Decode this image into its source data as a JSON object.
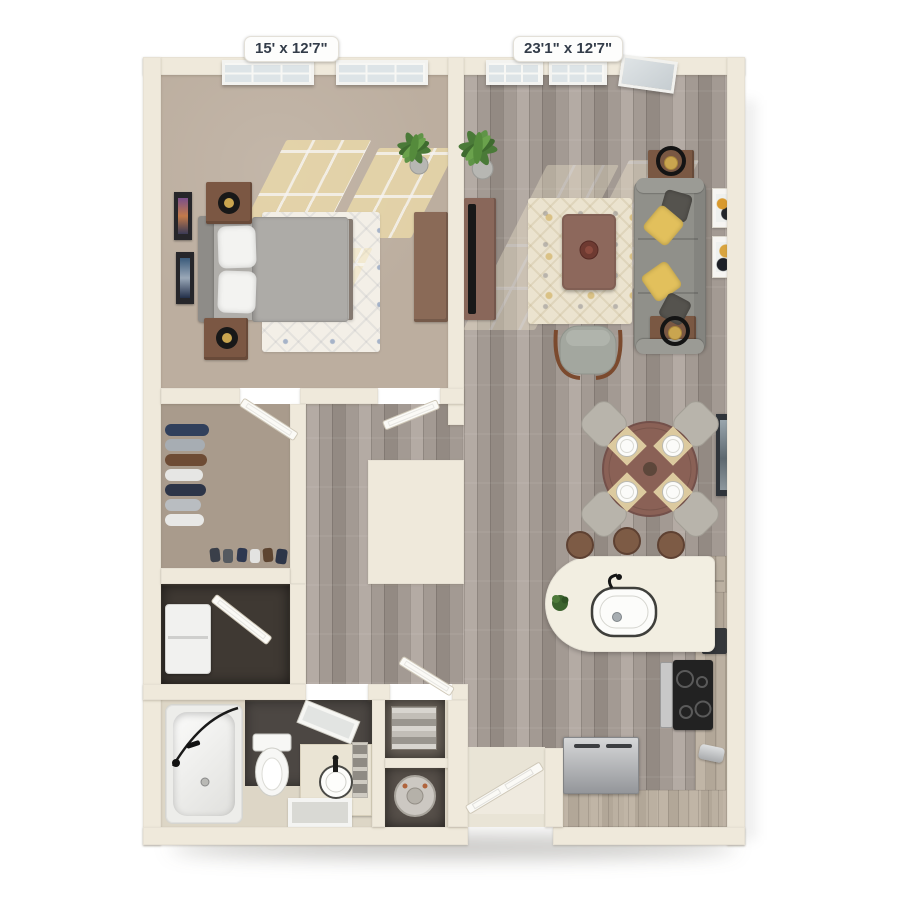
{
  "labels": {
    "bedroom_dimensions": "15' x 12'7\"",
    "living_dimensions": "23'1\" x 12'7\""
  },
  "palette": {
    "bg": "#ffffff",
    "wall": "#efe9db",
    "carpet": "#bcae9f",
    "carpet_closet": "#a99b8c",
    "wood": "#a39a93",
    "wood_dark": "#938a83",
    "wood_light": "#b4aba4",
    "counter": "#b6aa9b",
    "island": "#f2eee1",
    "rug_bedroom": "#f3efe7",
    "rug_living": "#ebe3cf",
    "sofa": "#90908a",
    "pillow_yellow": "#e2c05c",
    "pillow_gray": "#55534e",
    "furniture_brown": "#7b5743",
    "table_brown": "#8a6156",
    "bed_gray": "#b0aeaa",
    "bath_dark": "#4c4743",
    "bath_tile": "#ddd6c6",
    "label_text": "#333c49"
  },
  "rooms": {
    "bedroom": {
      "label": "bedroom",
      "furniture": [
        "bed",
        "pillows",
        "headboard",
        "nightstand",
        "table-lamp",
        "dresser",
        "area-rug",
        "plant",
        "wall-art",
        "windows"
      ]
    },
    "living_room": {
      "label": "living-room",
      "furniture": [
        "sofa",
        "throw-pillows",
        "end-table",
        "ring-lamp",
        "coffee-table",
        "tv-console",
        "tv",
        "accent-chair",
        "area-rug",
        "plant",
        "wall-art",
        "balcony-door"
      ]
    },
    "dining_area": {
      "label": "dining-area",
      "furniture": [
        "round-table",
        "chairs",
        "place-settings",
        "wall-art"
      ]
    },
    "kitchen": {
      "label": "kitchen",
      "furniture": [
        "peninsula-counter",
        "sink",
        "bar-stools",
        "refrigerator",
        "range",
        "microwave",
        "toaster",
        "cabinets",
        "entry-door"
      ]
    },
    "walk_in_closet": {
      "label": "walk-in-closet",
      "furniture": [
        "hanging-clothes",
        "shoes",
        "door"
      ]
    },
    "laundry_closet": {
      "label": "laundry-closet",
      "furniture": [
        "washer-dryer",
        "bifold-door"
      ]
    },
    "bathroom": {
      "label": "bathroom",
      "furniture": [
        "bathtub",
        "toilet",
        "vanity",
        "vessel-sink",
        "mirror",
        "bath-mat",
        "linen-shelves",
        "water-heater"
      ]
    }
  }
}
